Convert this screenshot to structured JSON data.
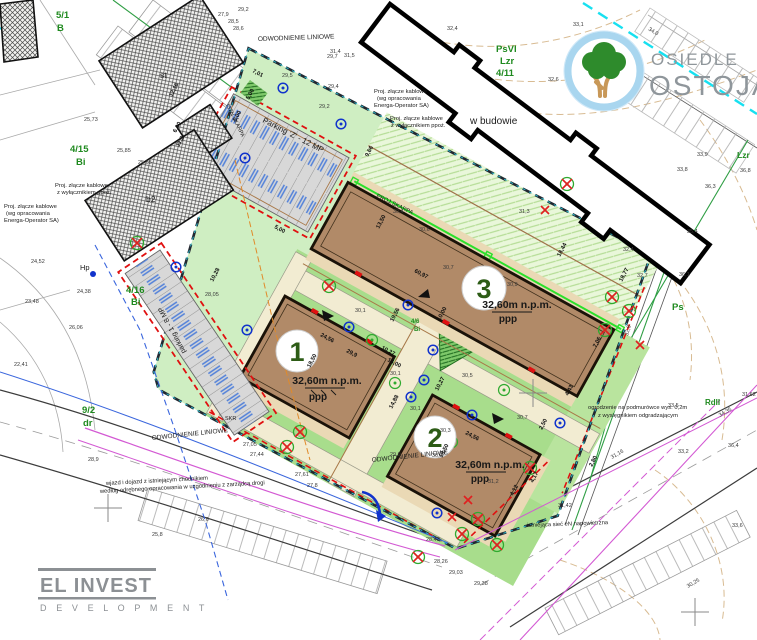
{
  "colors": {
    "site_green": "#cfeec2",
    "lawn_green": "#a8dd8c",
    "skarpa_green": "#e9f7da",
    "building_brown": "#b18a68",
    "terrace_tan": "#ead9b5",
    "parking_gray": "#d8d8d8",
    "boundary_teal": "#2ab6c8",
    "fire_red": "#e01010",
    "logo_ring_blue": "#a9d6ef",
    "tree_green": "#2e8b2c",
    "trunk_brown": "#c89858",
    "brand_gray": "#8f969b"
  },
  "branding": {
    "estate": {
      "top": "OSIEDLE",
      "bottom": "OSTOJA"
    },
    "developer": {
      "name": "EL INVEST",
      "sub": "D E V E L O P M E N T"
    }
  },
  "buildings": [
    {
      "label": "1",
      "elevation": "32,60m n.p.m.",
      "floor": "ppp"
    },
    {
      "label": "2",
      "elevation": "32,60m n.p.m.",
      "floor": "ppp"
    },
    {
      "label": "3",
      "elevation": "32,60m n.p.m.",
      "floor": "ppp"
    }
  ],
  "notes": [
    {
      "t": "ODWODNIENIE LINIOWE",
      "x": 258,
      "y": 41,
      "r": -2,
      "s": 6.5
    },
    {
      "t": "ODWODNIENIE LINIOWE",
      "x": 152,
      "y": 440,
      "r": -6,
      "s": 6.5
    },
    {
      "t": "ODWODNIENIE LINIOWE",
      "x": 372,
      "y": 462,
      "r": -6,
      "s": 6.5
    },
    {
      "t": "Proj. złącze kablowe",
      "x": 374,
      "y": 93,
      "r": 0,
      "s": 5.8
    },
    {
      "t": "(wg opracowania",
      "x": 377,
      "y": 100,
      "r": 0,
      "s": 5.8
    },
    {
      "t": "Energa-Operator SA)",
      "x": 374,
      "y": 107,
      "r": 0,
      "s": 5.8
    },
    {
      "t": "Proj. złącze kablowe",
      "x": 390,
      "y": 120,
      "r": 0,
      "s": 5.8
    },
    {
      "t": "z wyłącznikiem ppoż.",
      "x": 391,
      "y": 127,
      "r": 0,
      "s": 5.8
    },
    {
      "t": "Proj. złącze kablowe",
      "x": 55,
      "y": 187,
      "r": 0,
      "s": 5.8
    },
    {
      "t": "z wyłącznikiem ppoż.",
      "x": 57,
      "y": 194,
      "r": 0,
      "s": 5.8
    },
    {
      "t": "Proj. złącze kablowe",
      "x": 4,
      "y": 208,
      "r": 0,
      "s": 5.8
    },
    {
      "t": "(wg opracowania",
      "x": 6,
      "y": 215,
      "r": 0,
      "s": 5.8
    },
    {
      "t": "Energa-Operator SA)",
      "x": 4,
      "y": 222,
      "r": 0,
      "s": 5.8
    },
    {
      "t": "w budowie",
      "x": 470,
      "y": 124,
      "r": 0,
      "s": 10
    },
    {
      "t": "PROJ.SKARPA",
      "x": 376,
      "y": 197,
      "r": 26,
      "s": 5.8
    },
    {
      "t": "ISTN.SKARPA",
      "x": 226,
      "y": 105,
      "r": 64,
      "s": 5.5
    },
    {
      "t": "Parking 'Z' - 12 MP",
      "x": 262,
      "y": 122,
      "r": 27,
      "s": 8
    },
    {
      "t": "parking 1 - 8 MP",
      "x": 186,
      "y": 352,
      "r": -118,
      "s": 7
    },
    {
      "t": "wjazd i dojazd z istniejącym chodnikiem",
      "x": 106,
      "y": 485,
      "r": -3,
      "s": 5.8
    },
    {
      "t": "według odrębnego opracowania w uzgodnieniu z zarządcą drogi",
      "x": 100,
      "y": 493,
      "r": -3,
      "s": 5.8
    },
    {
      "t": "ogrodzenie na podmurówce wys. 0,2m",
      "x": 588,
      "y": 409,
      "r": 0,
      "s": 5.8
    },
    {
      "t": "z wysięgnikiem odgradzającym",
      "x": 598,
      "y": 417,
      "r": 0,
      "s": 5.8
    },
    {
      "t": "istniejąca sieć eN napowietrzna",
      "x": 527,
      "y": 527,
      "r": -2,
      "s": 5.8
    },
    {
      "t": "Hp",
      "x": 80,
      "y": 270,
      "r": 0,
      "s": 7.5
    },
    {
      "t": "st",
      "x": 160,
      "y": 78,
      "r": 0,
      "s": 8.5
    },
    {
      "t": "b2",
      "x": 146,
      "y": 202,
      "r": 0,
      "s": 8.5
    },
    {
      "t": "SKR",
      "x": 225,
      "y": 420,
      "r": 0,
      "s": 5.5
    }
  ],
  "dimensions": [
    {
      "t": "60,97",
      "x": 414,
      "y": 272,
      "r": 28
    },
    {
      "t": "13,50",
      "x": 379,
      "y": 229,
      "r": -62
    },
    {
      "t": "7,06",
      "x": 596,
      "y": 348,
      "r": -62
    },
    {
      "t": "18,44",
      "x": 560,
      "y": 257,
      "r": -62
    },
    {
      "t": "18,77",
      "x": 622,
      "y": 282,
      "r": -62
    },
    {
      "t": "24,56",
      "x": 320,
      "y": 336,
      "r": 28
    },
    {
      "t": "29,9",
      "x": 346,
      "y": 352,
      "r": 28
    },
    {
      "t": "18,50",
      "x": 310,
      "y": 368,
      "r": -62
    },
    {
      "t": "24,56",
      "x": 465,
      "y": 434,
      "r": 28
    },
    {
      "t": "18,50",
      "x": 442,
      "y": 458,
      "r": -62
    },
    {
      "t": "19,56",
      "x": 393,
      "y": 322,
      "r": -62
    },
    {
      "t": "10,27",
      "x": 381,
      "y": 349,
      "r": 28
    },
    {
      "t": "16,00",
      "x": 387,
      "y": 361,
      "r": 28
    },
    {
      "t": "10,00",
      "x": 440,
      "y": 321,
      "r": -62
    },
    {
      "t": "10,27",
      "x": 438,
      "y": 391,
      "r": -62
    },
    {
      "t": "14,88",
      "x": 392,
      "y": 409,
      "r": -62
    },
    {
      "t": "12,16",
      "x": 172,
      "y": 97,
      "r": -62
    },
    {
      "t": "6,00",
      "x": 176,
      "y": 133,
      "r": -62
    },
    {
      "t": "11,2",
      "x": 179,
      "y": 147,
      "r": -62
    },
    {
      "t": "5,00",
      "x": 236,
      "y": 122,
      "r": -62
    },
    {
      "t": "5,00",
      "x": 249,
      "y": 100,
      "r": -62
    },
    {
      "t": "7,01",
      "x": 252,
      "y": 72,
      "r": 28
    },
    {
      "t": "10,28",
      "x": 213,
      "y": 282,
      "r": -62
    },
    {
      "t": "5,00",
      "x": 274,
      "y": 228,
      "r": 28
    },
    {
      "t": "9,66",
      "x": 368,
      "y": 157,
      "r": -62
    },
    {
      "t": "4,43",
      "x": 568,
      "y": 396,
      "r": -62
    },
    {
      "t": "2,80",
      "x": 592,
      "y": 467,
      "r": -62
    },
    {
      "t": "4,17",
      "x": 533,
      "y": 483,
      "r": -62
    },
    {
      "t": "4,12",
      "x": 513,
      "y": 496,
      "r": -62
    },
    {
      "t": "2,50",
      "x": 542,
      "y": 430,
      "r": -62
    }
  ],
  "spot_elevations": [
    {
      "t": "29,2",
      "x": 238,
      "y": 11
    },
    {
      "t": "27,9",
      "x": 218,
      "y": 16
    },
    {
      "t": "28,5",
      "x": 228,
      "y": 23
    },
    {
      "t": "28,6",
      "x": 233,
      "y": 30
    },
    {
      "t": "29,7",
      "x": 327,
      "y": 58
    },
    {
      "t": "31,4",
      "x": 330,
      "y": 53
    },
    {
      "t": "31,5",
      "x": 344,
      "y": 57
    },
    {
      "t": "29,5",
      "x": 282,
      "y": 77
    },
    {
      "t": "29,4",
      "x": 328,
      "y": 88
    },
    {
      "t": "29,2",
      "x": 319,
      "y": 108
    },
    {
      "t": "32,4",
      "x": 447,
      "y": 30
    },
    {
      "t": "33,1",
      "x": 573,
      "y": 26
    },
    {
      "t": "32,6",
      "x": 548,
      "y": 81
    },
    {
      "t": "30,4",
      "x": 393,
      "y": 213
    },
    {
      "t": "30,6",
      "x": 419,
      "y": 231
    },
    {
      "t": "30,7",
      "x": 443,
      "y": 269
    },
    {
      "t": "30,9",
      "x": 507,
      "y": 286
    },
    {
      "t": "31,3",
      "x": 519,
      "y": 213
    },
    {
      "t": "30,1",
      "x": 355,
      "y": 312
    },
    {
      "t": "30,5",
      "x": 462,
      "y": 377
    },
    {
      "t": "30,1",
      "x": 390,
      "y": 375
    },
    {
      "t": "30,7",
      "x": 517,
      "y": 419
    },
    {
      "t": "30,3",
      "x": 440,
      "y": 432
    },
    {
      "t": "30,3",
      "x": 432,
      "y": 457
    },
    {
      "t": "31,2",
      "x": 488,
      "y": 483
    },
    {
      "t": "30,1",
      "x": 410,
      "y": 410
    },
    {
      "t": "29,9",
      "x": 390,
      "y": 456
    },
    {
      "t": "36,3",
      "x": 705,
      "y": 188
    },
    {
      "t": "33,8",
      "x": 677,
      "y": 171
    },
    {
      "t": "33,9",
      "x": 697,
      "y": 156
    },
    {
      "t": "36,8",
      "x": 740,
      "y": 172
    },
    {
      "t": "35,4",
      "x": 687,
      "y": 233
    },
    {
      "t": "36,1",
      "x": 679,
      "y": 276
    },
    {
      "t": "32,7",
      "x": 637,
      "y": 277
    },
    {
      "t": "32,4",
      "x": 623,
      "y": 251
    },
    {
      "t": "33,2",
      "x": 678,
      "y": 453
    },
    {
      "t": "36,4",
      "x": 728,
      "y": 447
    },
    {
      "t": "33,6",
      "x": 732,
      "y": 527
    },
    {
      "t": "33,5",
      "x": 668,
      "y": 407
    },
    {
      "t": "27,8",
      "x": 307,
      "y": 487
    },
    {
      "t": "26,6",
      "x": 198,
      "y": 521
    },
    {
      "t": "25,8",
      "x": 152,
      "y": 536
    },
    {
      "t": "25,73",
      "x": 84,
      "y": 121,
      "c": "#cc2400"
    },
    {
      "t": "25,85",
      "x": 117,
      "y": 152,
      "c": "#cc2400"
    },
    {
      "t": "25,65",
      "x": 138,
      "y": 164,
      "c": "#cc2400"
    },
    {
      "t": "34,0",
      "x": 648,
      "y": 30,
      "r": 31,
      "c": "#cc2400"
    },
    {
      "t": "31,42",
      "x": 558,
      "y": 507,
      "c": "#cc2400"
    },
    {
      "t": "31,62",
      "x": 742,
      "y": 396,
      "c": "#cc2400"
    },
    {
      "t": "28,9",
      "x": 88,
      "y": 461,
      "c": "#cc5500"
    },
    {
      "t": "32,8",
      "x": 628,
      "y": 336,
      "r": -75,
      "c": "#b08948"
    },
    {
      "t": "22,41",
      "x": 14,
      "y": 366,
      "c": "#2b4fd0"
    },
    {
      "t": "24,38",
      "x": 77,
      "y": 293,
      "c": "#2b4fd0"
    },
    {
      "t": "26,06",
      "x": 69,
      "y": 329,
      "c": "#2b4fd0"
    },
    {
      "t": "23,48",
      "x": 25,
      "y": 303,
      "c": "#2b4fd0"
    },
    {
      "t": "28,05",
      "x": 205,
      "y": 296,
      "c": "#2b4fd0"
    },
    {
      "t": "28,43",
      "x": 426,
      "y": 541,
      "c": "#2b4fd0"
    },
    {
      "t": "29,03",
      "x": 449,
      "y": 574,
      "c": "#2b4fd0"
    },
    {
      "t": "29,38",
      "x": 474,
      "y": 585,
      "c": "#2b4fd0"
    },
    {
      "t": "28,26",
      "x": 434,
      "y": 563,
      "c": "#2b4fd0"
    },
    {
      "t": "24,52",
      "x": 31,
      "y": 263,
      "c": "#c43ac4"
    },
    {
      "t": "27,05",
      "x": 243,
      "y": 446,
      "c": "#c43ac4"
    },
    {
      "t": "27,44",
      "x": 250,
      "y": 456,
      "c": "#c43ac4"
    },
    {
      "t": "27,61",
      "x": 295,
      "y": 476,
      "c": "#c43ac4"
    },
    {
      "t": "31,16",
      "x": 612,
      "y": 459,
      "r": -30,
      "c": "#c43ac4"
    },
    {
      "t": "34,35",
      "x": 720,
      "y": 417,
      "r": -30,
      "c": "#c43ac4"
    },
    {
      "t": "30,25",
      "x": 688,
      "y": 588,
      "r": -30,
      "c": "#c43ac4"
    }
  ],
  "parcel_labels": [
    {
      "t": "5/1",
      "x": 56,
      "y": 18,
      "s": 9.5
    },
    {
      "t": "B",
      "x": 57,
      "y": 31,
      "s": 9.5
    },
    {
      "t": "4/15",
      "x": 70,
      "y": 152,
      "s": 9.5
    },
    {
      "t": "Bi",
      "x": 76,
      "y": 165,
      "s": 9.5
    },
    {
      "t": "4/16",
      "x": 126,
      "y": 293,
      "s": 9.5
    },
    {
      "t": "Bi",
      "x": 131,
      "y": 305,
      "s": 9.5
    },
    {
      "t": "9/2",
      "x": 82,
      "y": 413,
      "s": 9.5
    },
    {
      "t": "dr",
      "x": 83,
      "y": 426,
      "s": 9.5
    },
    {
      "t": "4/6",
      "x": 411,
      "y": 323,
      "s": 6
    },
    {
      "t": "Bi",
      "x": 414,
      "y": 331,
      "s": 6
    },
    {
      "t": "PsVI",
      "x": 496,
      "y": 52,
      "s": 9.5
    },
    {
      "t": "Lzr",
      "x": 500,
      "y": 64,
      "s": 9.5
    },
    {
      "t": "4/11",
      "x": 496,
      "y": 76,
      "s": 9.5
    },
    {
      "t": "Ps",
      "x": 672,
      "y": 310,
      "s": 9.5
    },
    {
      "t": "Lzr",
      "x": 737,
      "y": 158,
      "s": 8.5
    },
    {
      "t": "RdII",
      "x": 705,
      "y": 405,
      "s": 8
    }
  ]
}
